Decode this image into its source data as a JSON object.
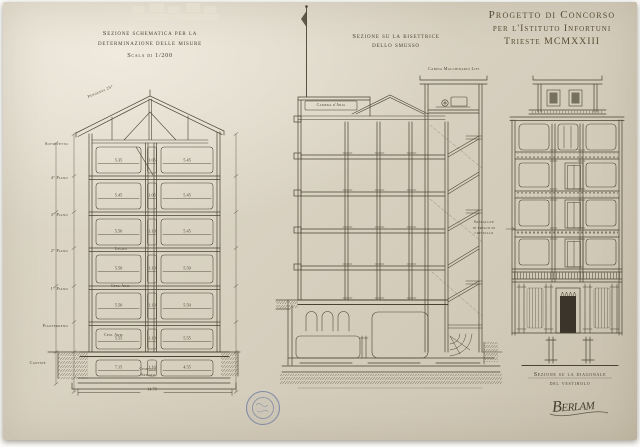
{
  "document": {
    "title_line1": "Progetto di Concorso",
    "title_line2": "per l'Istituto Infortuni",
    "title_line3": "Trieste MCMXXIII",
    "signature": "Berlam"
  },
  "left_section": {
    "title_line1": "Sezione schematica per la",
    "title_line2": "determinazione delle misure",
    "scale_note": "Scala di 1/200",
    "roof_slope_label": "Pendenza 25°",
    "floors": [
      {
        "label": "Sottotetto",
        "left": "5.35",
        "mid": "1.05",
        "right": "5.45"
      },
      {
        "label": "4° Piano",
        "left": "5.45",
        "mid": "1.05",
        "right": "5.45"
      },
      {
        "label": "3° Piano",
        "left": "5.50",
        "mid": "1.10",
        "right": "5.45"
      },
      {
        "label": "2° Piano",
        "left": "5.50",
        "mid": "1.10",
        "right": "5.50"
      },
      {
        "label": "1° Piano",
        "left": "5.50",
        "mid": "1.10",
        "right": "5.50"
      },
      {
        "label": "Pianterreno",
        "left": "5.55",
        "mid": "1.10",
        "right": "5.55"
      },
      {
        "label": "Cantine",
        "left": "7.15",
        "mid": "1.10",
        "right": "4.55"
      }
    ],
    "slab_material_wood": "Legno",
    "slab_material_concrete_upper": "Cem. Arm.",
    "slab_material_concrete_lower": "Cem. Arm.",
    "foundation_material_line1": "Cemento",
    "foundation_material_line2": "Armato",
    "total_width": "14.70"
  },
  "middle_section": {
    "title_line1": "Sezione su la bisettrice",
    "title_line2": "dello smusso",
    "lift_cabin_label": "Cabina Macchinario Lift",
    "air_chamber_label": "Camera d'Aria"
  },
  "right_section": {
    "title_line1": "Sezione su la diagonale",
    "title_line2": "del vestibolo",
    "skylight_label_line1": "Sopraluce",
    "skylight_label_line2": "in fregio di",
    "skylight_label_line3": "cristallo"
  },
  "colors": {
    "paper": "#d8d1c1",
    "ink": "#4a4334",
    "stamp": "#68779c"
  }
}
